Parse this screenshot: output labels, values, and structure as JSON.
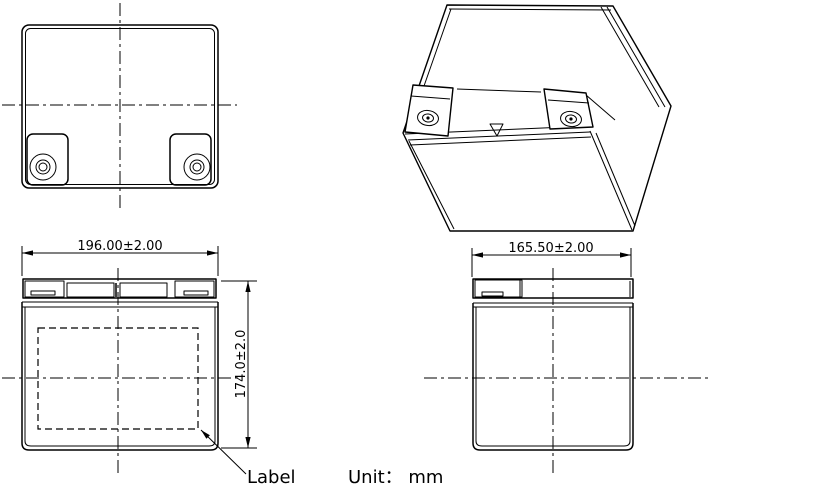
{
  "drawing": {
    "label_callout": "Label",
    "unit_note": "Unit： mm",
    "front_view": {
      "width_dim": "196.00±2.00",
      "height_dim": "174.0±2.0"
    },
    "side_view": {
      "depth_dim": "165.50±2.00"
    },
    "colors": {
      "line": "#000000",
      "background": "#ffffff"
    }
  }
}
